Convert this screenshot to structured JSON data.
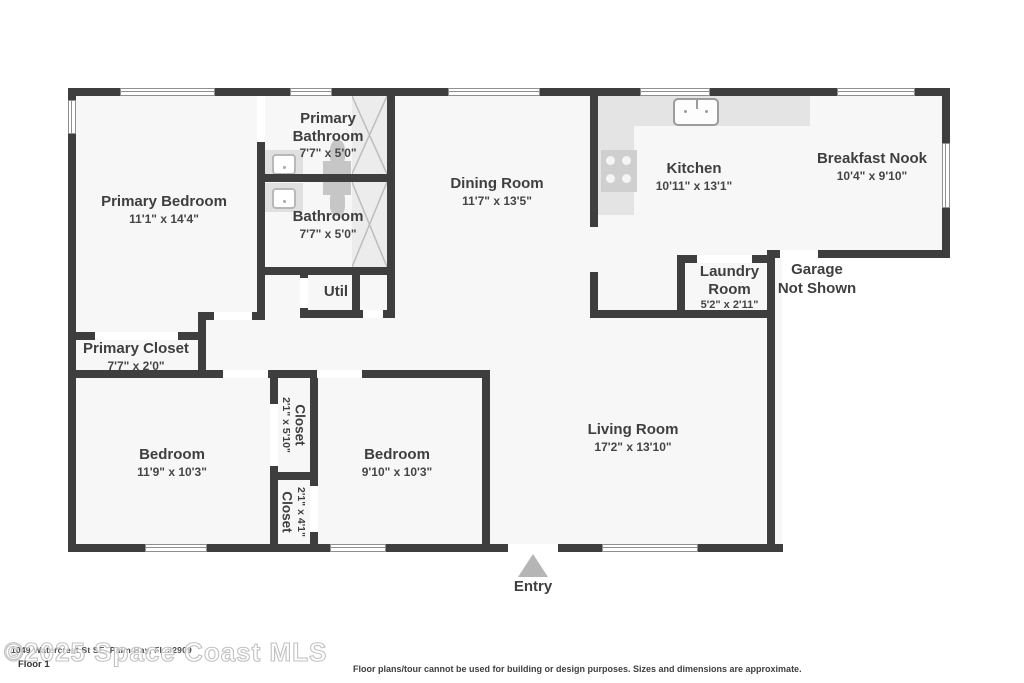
{
  "rooms": {
    "primary_bedroom": {
      "name": "Primary Bedroom",
      "dims": "11'1\" x 14'4\""
    },
    "primary_bathroom": {
      "name": "Primary Bathroom",
      "dims": "7'7\" x 5'0\""
    },
    "bathroom": {
      "name": "Bathroom",
      "dims": "7'7\" x 5'0\""
    },
    "dining_room": {
      "name": "Dining Room",
      "dims": "11'7\" x 13'5\""
    },
    "kitchen": {
      "name": "Kitchen",
      "dims": "10'11\" x 13'1\""
    },
    "breakfast_nook": {
      "name": "Breakfast Nook",
      "dims": "10'4\" x 9'10\""
    },
    "laundry_room": {
      "name": "Laundry Room",
      "dims": "5'2\" x 2'11\""
    },
    "primary_closet": {
      "name": "Primary Closet",
      "dims": "7'7\" x 2'0\""
    },
    "util": {
      "name": "Util"
    },
    "bedroom_left": {
      "name": "Bedroom",
      "dims": "11'9\" x 10'3\""
    },
    "bedroom_right": {
      "name": "Bedroom",
      "dims": "9'10\" x 10'3\""
    },
    "closet_hall": {
      "name": "Closet",
      "dims": "2'1\" x 5'10\""
    },
    "closet_lower": {
      "name": "Closet",
      "dims": "2'1\" x 4'1\""
    },
    "living_room": {
      "name": "Living Room",
      "dims": "17'2\" x 13'10\""
    }
  },
  "annotations": {
    "entry": "Entry",
    "garage_line1": "Garage",
    "garage_line2": "Not Shown",
    "floor_label": "Floor 1",
    "watermark": "©2025 Space Coast MLS",
    "address": "1049 Watercrest St SE, Palm Bay, FL 32909",
    "disclaimer": "Floor plans/tour cannot be used for building or design purposes. Sizes and dimensions are approximate."
  },
  "colors": {
    "wall": "#3e3e3e",
    "floor": "#f7f7f7",
    "text": "#3f3f3f",
    "fixture": "#c6c6c6",
    "counter": "#e4e4e4",
    "entry_arrow": "#b5b5b5",
    "watermark_outline": "#c2c2c2"
  }
}
